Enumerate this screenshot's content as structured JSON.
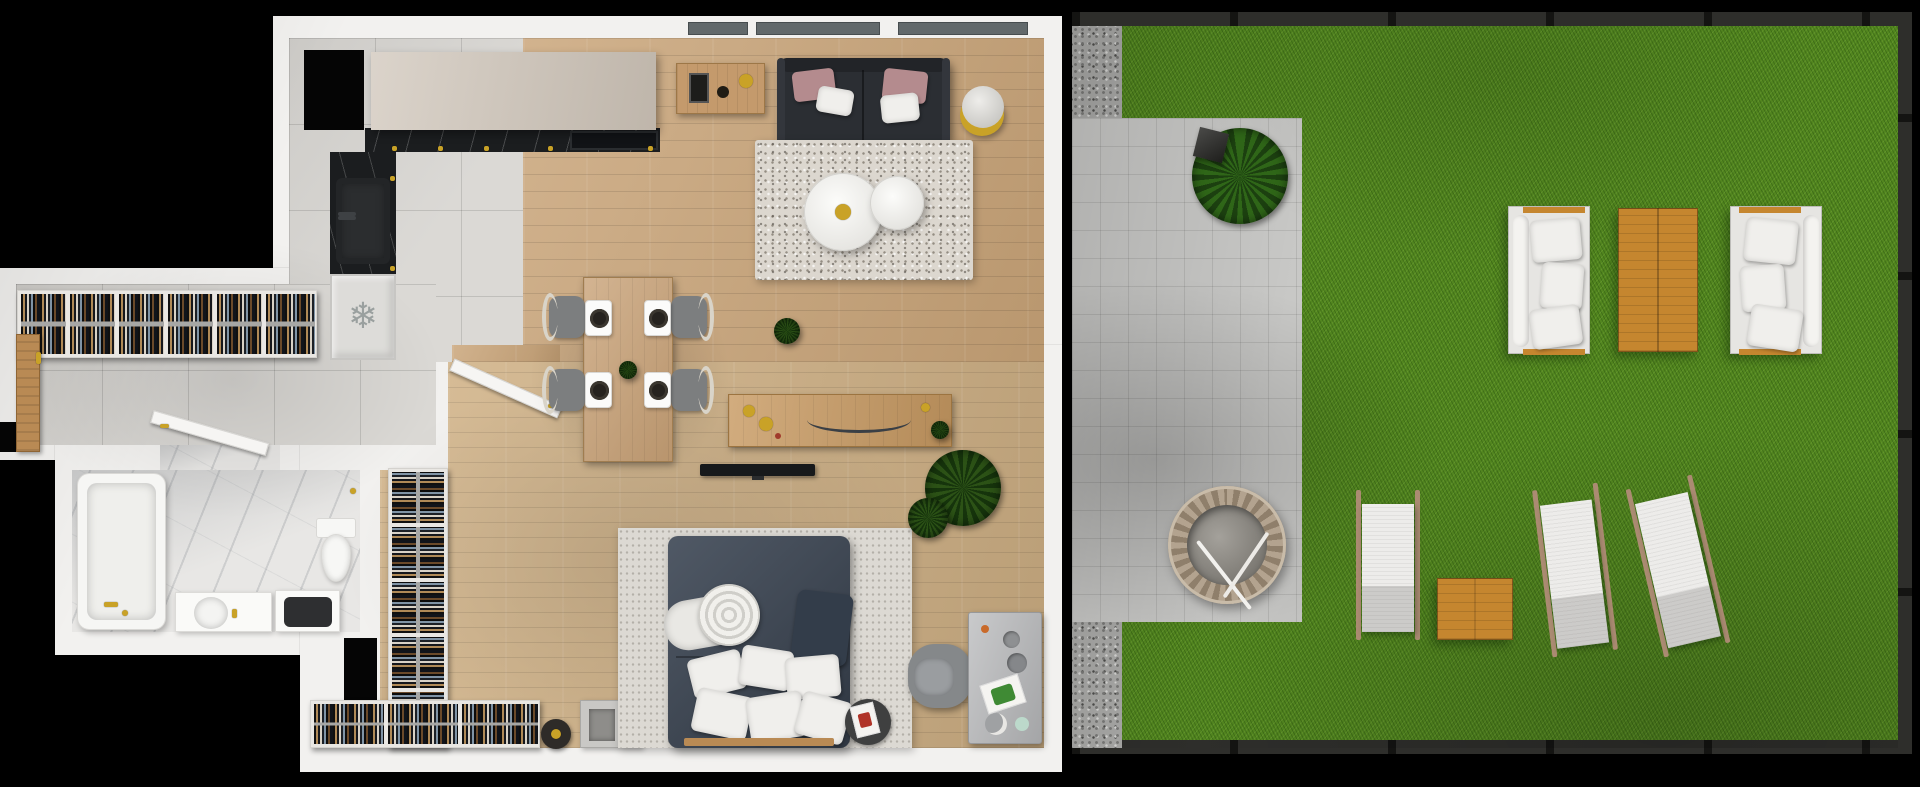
{
  "meta": {
    "title": "apartment-floor-plan-top-view-3d-render",
    "text_content": "none"
  },
  "icons": {
    "snowflake": "❄"
  },
  "palette": {
    "bg": "#000000",
    "wall": "#f2f1ef",
    "tile": "#d8d6d2",
    "wood": "#c9a478",
    "wood2": "#cfb084",
    "marble": "#e8e7e5",
    "counter": "#1b1d1f",
    "cabinet": "#cfc5b9",
    "sofa": "#2b2e33",
    "pink": "#b48b8e",
    "navy": "#3c4654",
    "rug": "#dcd7cf",
    "bedrug": "#dcd9d3",
    "grass": "#52861f",
    "patio": "#c8c8c6",
    "gravel": "#a9a9a7",
    "fence": "#232321",
    "gardenwood": "#c5862f",
    "loungewood": "#ab8b72",
    "gold": "#c9a227",
    "plant": "#2c5216",
    "graydesk": "#b7b8ba",
    "whitecushion": "#f0efec"
  }
}
